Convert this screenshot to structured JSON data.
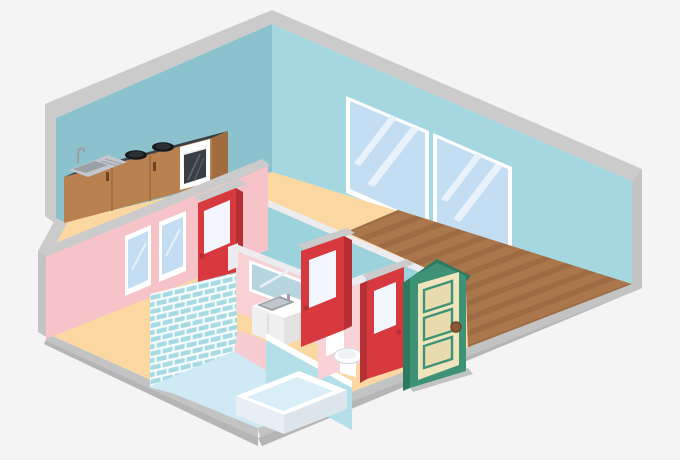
{
  "illustration": {
    "kind": "isometric-apartment-cutaway",
    "rooms": {
      "kitchen": {
        "objects": [
          "counter",
          "sink",
          "faucet",
          "stove-burners",
          "oven",
          "cabinet-doors"
        ],
        "burner_count": 2
      },
      "living_room": {
        "objects": [
          "large-window",
          "large-window",
          "wood-plank-floor"
        ],
        "window_count": 2
      },
      "bathroom": {
        "objects": [
          "tiled-shower-wall",
          "bathtub",
          "glass-partition",
          "vanity-sink",
          "mirror",
          "toilet"
        ],
        "small_window_count": 2
      }
    },
    "doors": {
      "red_interior_doors": 3,
      "green_entry_door": 1
    }
  },
  "colors": {
    "bg": "#f4f4f5",
    "grayLight": "#cbcbcb",
    "grayMid": "#c3c3c3",
    "grayDark": "#b5b5b5",
    "capWhite": "#ececee",
    "wallBackLeft": "#8cc2ce",
    "wallBackRight": "#a4d7e0",
    "wallBlueInner": "#9cd2dc",
    "pinkWall": "#f6c3c8",
    "pinkLight": "#f9d2d6",
    "pinkFloor": "#f7cdd2",
    "peach": "#fbd8a2",
    "wood": "#a9774b",
    "woodStripe": "#9d6c44",
    "bathFloor": "#cfe9f5",
    "tile": "#a5dbe3",
    "grout": "#f7fbfc",
    "white": "#ffffff",
    "offWhite": "#f0f0f0",
    "glassBlue": "#c3ddf3",
    "glassStreak": "#e9f2fb",
    "mirrorGlass": "#b7d5df",
    "partition": "#b3dfe8",
    "red": "#d8393e",
    "redDark": "#b52f35",
    "doorGlass": "#f3f6fc",
    "green": "#3e9377",
    "greenDark": "#2e7a61",
    "cream": "#efe4ba",
    "creamDark": "#e8dcae",
    "knobBrown": "#8a5a33",
    "counterTop": "#3a3f45",
    "counterStreak": "#596068",
    "cabinet": "#b8814f",
    "cabinetDark": "#a26c41",
    "handle": "#6b4526",
    "steel": "#c2c7cc",
    "steelDark": "#9aa0a6",
    "tubSide": "#e9eef4",
    "tubSide2": "#dce4ec",
    "water": "#daeef8"
  }
}
